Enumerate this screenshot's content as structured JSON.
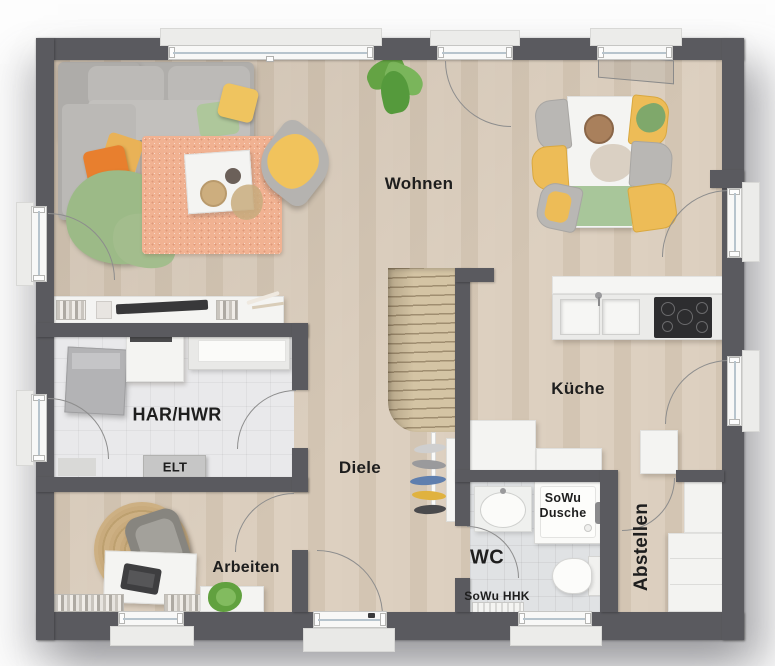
{
  "plan": {
    "type": "floor-plan",
    "labels": {
      "wohnen": "Wohnen",
      "kueche": "Küche",
      "har_hwr": "HAR/HWR",
      "elt": "ELT",
      "diele": "Diele",
      "arbeiten": "Arbeiten",
      "wc": "WC",
      "sowu_line1": "SoWu",
      "sowu_line2": "Dusche",
      "sowu_hhk": "SoWu HHK",
      "abstellen": "Abstellen"
    },
    "colors": {
      "wall": "#5a5a5f",
      "wood_floor": "#d8cbbb",
      "utility_tile_floor": "#e9e9eb",
      "wc_tile_floor": "#e0e2e4",
      "rug_salmon": "#f1b292",
      "rug_jute": "#c9ab7d",
      "accent_yellow": "#edbc57",
      "accent_orange": "#e87f2e",
      "accent_green": "#a8c69a",
      "cooktop_black": "#2d2d2f",
      "label_text": "#1e1e1e"
    }
  }
}
